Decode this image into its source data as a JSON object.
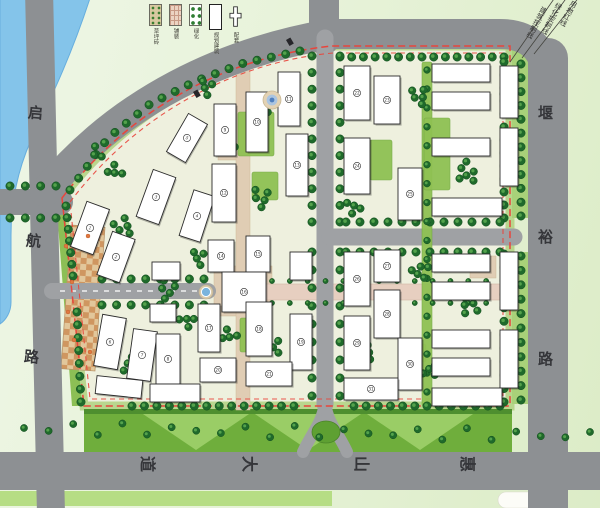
{
  "legend": {
    "items": [
      {
        "name": "grass-paver",
        "label": "草坪砖"
      },
      {
        "name": "paving",
        "label": "铺装"
      },
      {
        "name": "planting",
        "label": "绿化"
      },
      {
        "name": "planned-building",
        "label": "规划建筑"
      },
      {
        "name": "amenity",
        "label": "配套"
      }
    ]
  },
  "control_lines": [
    {
      "label": "用地红线",
      "x": 571,
      "y": 1
    },
    {
      "label": "绿化控制线",
      "x": 556,
      "y": 3
    },
    {
      "label": "建筑控制线",
      "x": 541,
      "y": 7
    }
  ],
  "road_labels": [
    {
      "text": "启",
      "x": 28,
      "y": 106,
      "rot": 5,
      "size": 15
    },
    {
      "text": "航",
      "x": 26,
      "y": 234,
      "rot": 5,
      "size": 15
    },
    {
      "text": "路",
      "x": 24,
      "y": 350,
      "rot": 5,
      "size": 15
    },
    {
      "text": "堰",
      "x": 538,
      "y": 106,
      "rot": 0,
      "size": 15
    },
    {
      "text": "裕",
      "x": 538,
      "y": 230,
      "rot": 0,
      "size": 15
    },
    {
      "text": "路",
      "x": 538,
      "y": 352,
      "rot": 0,
      "size": 15
    },
    {
      "text": "惠",
      "x": 459,
      "y": 456,
      "rot": 90,
      "size": 16
    },
    {
      "text": "山",
      "x": 353,
      "y": 456,
      "rot": 90,
      "size": 16
    },
    {
      "text": "大",
      "x": 241,
      "y": 456,
      "rot": 90,
      "size": 16
    },
    {
      "text": "道",
      "x": 139,
      "y": 456,
      "rot": 90,
      "size": 16
    }
  ],
  "palette": {
    "road": "#8d9093",
    "road_minor": "#9fa1a4",
    "site": "#eef0de",
    "rim": "#b2d385",
    "tree_dark": "#1f6a2b",
    "tree_edge": "#124d1d",
    "tree_light": "#5aa850",
    "lawn": "#8fc153",
    "pave": "#e0cdb4",
    "axis": "#e7cfc0",
    "red_line": "#e8453c",
    "river": "#84c4ea",
    "river_edge": "#67aede",
    "band": "#6fae3c",
    "band_light": "#9ed06a",
    "band_dark": "#4e8f2f",
    "plaza_a": "#cf9660",
    "plaza_b": "#e2c79b",
    "building": "#ffffff",
    "outline": "#2b2b2b",
    "strip": "#a8d179"
  },
  "map": {
    "site": "M 332,46 L 510,46 L 510,406 L 84,406 L 62,198 C 135,102 235,56 332,46 Z",
    "river": "M 36,-8 L 92,-8 C 72,55 50,100 31,140 C 17,172 11,205 11,235 L 11,302 C 11,312 6,320 0,324 L 0,-8 Z",
    "roads": [
      {
        "d": "M 39,-10 L 51,514",
        "w": 28
      },
      {
        "d": "M -10,202 L 60,202",
        "w": 26
      },
      {
        "d": "M 45,192 C 120,100 225,52 330,34 L 500,34 Q 544,34 548,80",
        "w": 30
      },
      {
        "d": "M 324,-10 L 324,40",
        "w": 30
      },
      {
        "d": "M 548,58 L 548,514",
        "w": 40
      },
      {
        "d": "M -10,471 L 610,471",
        "w": 38
      },
      {
        "d": "M 325,38 L 325,404",
        "w": 17,
        "minor": true
      },
      {
        "d": "M 330,237 L 514,237",
        "w": 17,
        "minor": true
      },
      {
        "d": "M 52,291 L 208,291",
        "w": 16,
        "minor": true
      },
      {
        "d": "M 325,398 C 325,420 312,432 303,452",
        "w": 12,
        "minor": true
      },
      {
        "d": "M 325,398 C 325,420 338,432 347,452",
        "w": 12,
        "minor": true
      }
    ],
    "centerline": "M 60,291 L 202,291",
    "red_outer": "M 62,198 C 135,102 235,56 332,46 L 510,46 L 510,406 L 84,406 Z",
    "red_inner": "M 70,202 C 140,110 238,62 333,53 L 503,53 L 503,399 L 90,399 Z",
    "leader_lines": [
      "M 510,62 L 556,-4",
      "M 522,58 L 568,-4",
      "M 534,54 L 580,-4"
    ],
    "strips": [
      [
        512,
        48,
        18,
        170
      ],
      [
        512,
        252,
        18,
        152
      ]
    ],
    "west_strip": "M 56,198 L 64,198 L 82,406 L 72,406 Z",
    "band": [
      84,
      412,
      428,
      40
    ],
    "band_wedges": [
      [
        [
          140,
          412
        ],
        [
          196,
          450
        ],
        [
          252,
          412
        ]
      ],
      [
        [
          252,
          412
        ],
        [
          308,
          450
        ],
        [
          364,
          412
        ]
      ],
      [
        [
          364,
          412
        ],
        [
          420,
          450
        ],
        [
          476,
          412
        ]
      ]
    ],
    "band_strip": [
      84,
      409,
      428,
      5
    ],
    "bright_band": [
      0,
      491,
      332,
      15
    ],
    "white_lot": [
      498,
      492,
      62,
      16
    ],
    "plaza": [
      66,
      226,
      34,
      144,
      4
    ],
    "paves": [
      [
        214,
        266,
        58,
        50
      ],
      [
        470,
        256,
        26,
        22
      ],
      [
        218,
        132,
        22,
        28
      ],
      [
        236,
        62,
        14,
        348
      ]
    ],
    "axis": [
      266,
      284,
      244,
      16
    ],
    "lawns": [
      [
        238,
        112,
        36,
        44
      ],
      [
        252,
        172,
        26,
        28
      ],
      [
        404,
        344,
        22,
        18
      ],
      [
        422,
        62,
        10,
        344
      ],
      [
        240,
        318,
        28,
        34
      ],
      [
        370,
        140,
        22,
        40
      ],
      [
        424,
        118,
        26,
        72
      ]
    ],
    "island": [
      326,
      432,
      14,
      11
    ],
    "buildings": [
      [
        78,
        204,
        24,
        48,
        20
      ],
      [
        104,
        234,
        24,
        46,
        20
      ],
      [
        144,
        172,
        24,
        50,
        20
      ],
      [
        186,
        192,
        22,
        48,
        18
      ],
      [
        176,
        116,
        22,
        44,
        30
      ],
      [
        98,
        316,
        24,
        52,
        10
      ],
      [
        130,
        330,
        24,
        50,
        8
      ],
      [
        96,
        378,
        46,
        18,
        6
      ],
      [
        152,
        262,
        28,
        18,
        0
      ],
      [
        150,
        304,
        26,
        18,
        0
      ],
      [
        156,
        334,
        24,
        50,
        0
      ],
      [
        150,
        384,
        50,
        18,
        0
      ],
      [
        214,
        104,
        22,
        52,
        0
      ],
      [
        246,
        92,
        22,
        60,
        0
      ],
      [
        278,
        72,
        22,
        54,
        0
      ],
      [
        212,
        164,
        24,
        58,
        0
      ],
      [
        286,
        134,
        22,
        62,
        0
      ],
      [
        208,
        240,
        26,
        32,
        0
      ],
      [
        246,
        236,
        24,
        36,
        0
      ],
      [
        290,
        252,
        22,
        28,
        0
      ],
      [
        222,
        272,
        44,
        40,
        0
      ],
      [
        198,
        304,
        22,
        48,
        0
      ],
      [
        246,
        302,
        26,
        54,
        0
      ],
      [
        290,
        314,
        22,
        56,
        0
      ],
      [
        200,
        358,
        36,
        24,
        0
      ],
      [
        246,
        362,
        46,
        24,
        0
      ],
      [
        344,
        66,
        26,
        54,
        0
      ],
      [
        374,
        76,
        26,
        48,
        0
      ],
      [
        344,
        138,
        26,
        56,
        0
      ],
      [
        398,
        168,
        24,
        52,
        0
      ],
      [
        344,
        252,
        26,
        54,
        0
      ],
      [
        374,
        250,
        26,
        32,
        0
      ],
      [
        374,
        290,
        26,
        48,
        0
      ],
      [
        344,
        316,
        26,
        54,
        0
      ],
      [
        398,
        338,
        24,
        52,
        0
      ],
      [
        344,
        378,
        54,
        22,
        0
      ],
      [
        432,
        64,
        58,
        18,
        0
      ],
      [
        432,
        92,
        58,
        18,
        0
      ],
      [
        500,
        66,
        18,
        52,
        0
      ],
      [
        432,
        138,
        58,
        18,
        0
      ],
      [
        500,
        128,
        18,
        58,
        0
      ],
      [
        432,
        198,
        70,
        18,
        0
      ],
      [
        432,
        254,
        58,
        18,
        0
      ],
      [
        432,
        282,
        58,
        18,
        0
      ],
      [
        500,
        252,
        18,
        58,
        0
      ],
      [
        432,
        330,
        58,
        18,
        0
      ],
      [
        432,
        358,
        58,
        18,
        0
      ],
      [
        500,
        330,
        18,
        58,
        0
      ],
      [
        432,
        388,
        70,
        18,
        0
      ]
    ],
    "tree_rows": [
      {
        "p": [
          [
            340,
            57
          ],
          [
            504,
            57
          ]
        ],
        "n": 15
      },
      {
        "p": [
          [
            70,
            190
          ],
          [
            108,
            138
          ],
          [
            150,
            104
          ],
          [
            196,
            81
          ],
          [
            244,
            63
          ],
          [
            300,
            51
          ]
        ],
        "n": 20
      },
      {
        "p": [
          [
            66,
            206
          ],
          [
            73,
            276
          ]
        ],
        "n": 7
      },
      {
        "p": [
          [
            77,
            312
          ],
          [
            81,
            402
          ]
        ],
        "n": 8
      },
      {
        "p": [
          [
            504,
            62
          ],
          [
            504,
            218
          ]
        ],
        "n": 13
      },
      {
        "p": [
          [
            504,
            254
          ],
          [
            504,
            402
          ]
        ],
        "n": 12
      },
      {
        "p": [
          [
            132,
            406
          ],
          [
            294,
            406
          ]
        ],
        "n": 14
      },
      {
        "p": [
          [
            354,
            406
          ],
          [
            500,
            406
          ]
        ],
        "n": 13
      },
      {
        "p": [
          [
            312,
            56
          ],
          [
            312,
            222
          ]
        ],
        "n": 11
      },
      {
        "p": [
          [
            340,
            56
          ],
          [
            340,
            222
          ]
        ],
        "n": 11
      },
      {
        "p": [
          [
            312,
            252
          ],
          [
            312,
            396
          ]
        ],
        "n": 9
      },
      {
        "p": [
          [
            340,
            252
          ],
          [
            340,
            396
          ]
        ],
        "n": 9
      },
      {
        "p": [
          [
            346,
            222
          ],
          [
            500,
            222
          ]
        ],
        "n": 12
      },
      {
        "p": [
          [
            346,
            252
          ],
          [
            500,
            252
          ]
        ],
        "n": 12
      },
      {
        "p": [
          [
            102,
            279
          ],
          [
            204,
            279
          ]
        ],
        "n": 8
      },
      {
        "p": [
          [
            102,
            305
          ],
          [
            204,
            305
          ]
        ],
        "n": 8
      },
      {
        "p": [
          [
            521,
            64
          ],
          [
            521,
            216
          ]
        ],
        "n": 12
      },
      {
        "p": [
          [
            521,
            256
          ],
          [
            521,
            400
          ]
        ],
        "n": 11
      },
      {
        "p": [
          [
            10,
            186
          ],
          [
            56,
            186
          ]
        ],
        "n": 4
      },
      {
        "p": [
          [
            10,
            218
          ],
          [
            56,
            218
          ]
        ],
        "n": 4
      },
      {
        "p": [
          [
            427,
            70
          ],
          [
            427,
            392
          ]
        ],
        "n": 18,
        "r": 3.4
      },
      {
        "p": [
          [
            24,
            428
          ],
          [
            590,
            436
          ]
        ],
        "n": 24,
        "r": 3.6,
        "jitter": 6
      },
      {
        "p": [
          [
            272,
            281
          ],
          [
            504,
            281
          ]
        ],
        "n": 14,
        "r": 2.6
      },
      {
        "p": [
          [
            272,
            303
          ],
          [
            504,
            303
          ]
        ],
        "n": 14,
        "r": 2.6
      }
    ],
    "tree_clusters": [
      [
        124,
        226,
        5,
        11
      ],
      [
        168,
        290,
        5,
        11
      ],
      [
        116,
        170,
        4,
        9
      ],
      [
        200,
        258,
        4,
        9
      ],
      [
        130,
        366,
        5,
        11
      ],
      [
        186,
        322,
        4,
        9
      ],
      [
        228,
        142,
        5,
        10
      ],
      [
        262,
        198,
        5,
        11
      ],
      [
        230,
        334,
        4,
        9
      ],
      [
        276,
        346,
        4,
        9
      ],
      [
        256,
        138,
        4,
        9
      ],
      [
        264,
        108,
        4,
        9
      ],
      [
        352,
        108,
        4,
        9
      ],
      [
        420,
        96,
        5,
        10
      ],
      [
        466,
        172,
        6,
        12
      ],
      [
        420,
        272,
        5,
        10
      ],
      [
        468,
        306,
        5,
        11
      ],
      [
        430,
        372,
        4,
        9
      ],
      [
        352,
        208,
        4,
        9
      ],
      [
        366,
        352,
        4,
        9
      ],
      [
        508,
        96,
        3,
        7
      ],
      [
        96,
        152,
        3,
        8
      ],
      [
        208,
        88,
        4,
        9
      ]
    ],
    "markers": {
      "fountain": [
        206,
        292
      ],
      "round_plaza": [
        272,
        100
      ],
      "glyphs": [
        [
          193,
          92
        ],
        [
          286,
          40
        ]
      ],
      "flowers": [
        [
          66,
          246
        ],
        [
          72,
          282
        ],
        [
          68,
          312
        ],
        [
          74,
          340
        ],
        [
          88,
          236
        ],
        [
          90,
          352
        ]
      ]
    }
  }
}
